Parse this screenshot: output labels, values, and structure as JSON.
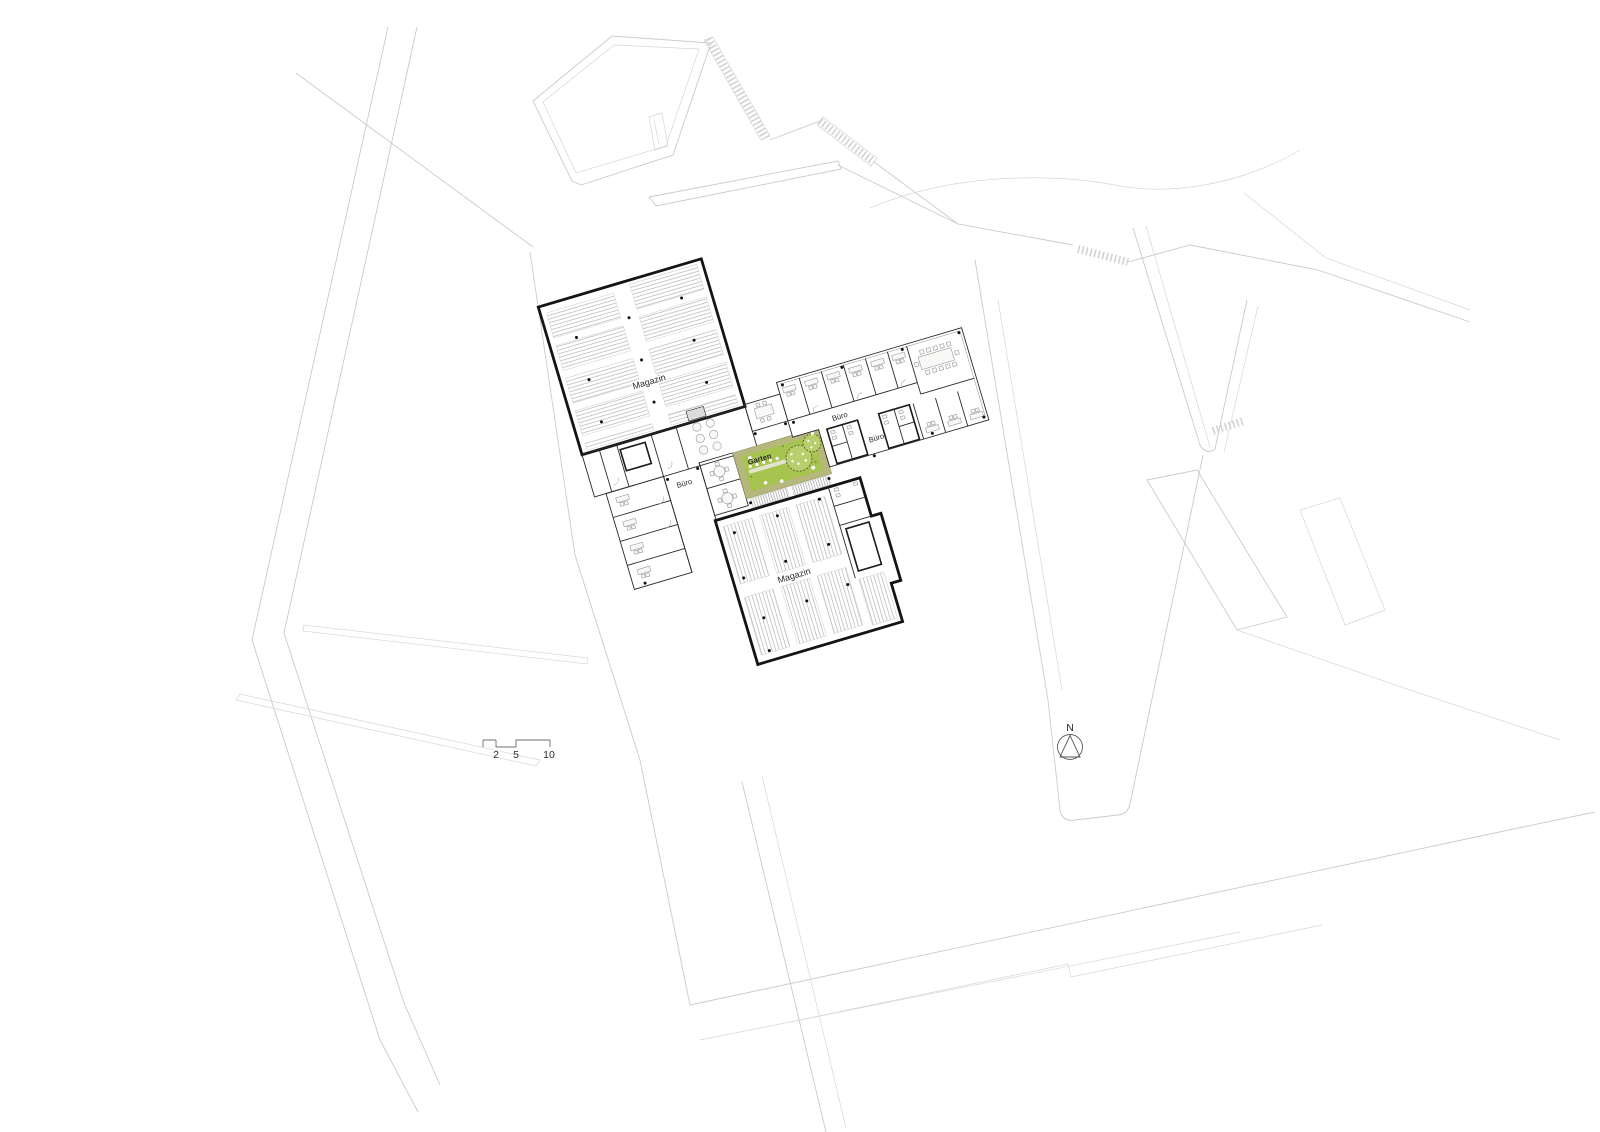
{
  "labels": {
    "magazin_upper": "Magazin",
    "magazin_lower": "Magazin",
    "garten": "Garten",
    "buero_left": "Büro",
    "buero_right_upper": "Büro",
    "buero_right_lower": "Büro"
  },
  "scale_bar": {
    "ticks": [
      "2",
      "5",
      "10"
    ]
  },
  "north_arrow": {
    "label": "N"
  },
  "colors": {
    "garden_border": "#b6b77c",
    "garden_inner": "#a6c44f",
    "tree_fill": "#b9cf6e",
    "tree_stroke": "#5f7033",
    "wall": "#141414",
    "shelf_line": "#b5b5b5",
    "furniture": "#9a9a9a",
    "context_line": "#cbcbcb"
  }
}
